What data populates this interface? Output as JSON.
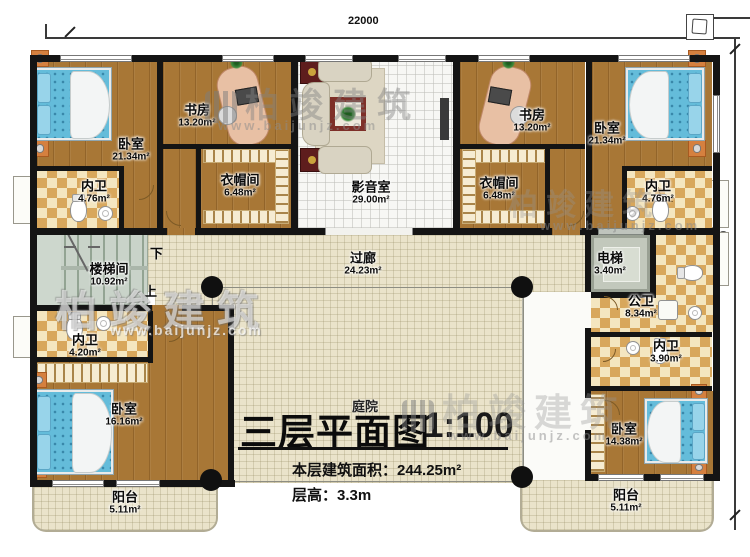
{
  "dimensions": {
    "width_top": "22000",
    "height_right": "15960"
  },
  "rooms": {
    "bedroom_top_left": {
      "name": "卧室",
      "area": "21.34m²"
    },
    "study_left": {
      "name": "书房",
      "area": "13.20m²"
    },
    "media_room": {
      "name": "影音室",
      "area": "29.00m²"
    },
    "study_right": {
      "name": "书房",
      "area": "13.20m²"
    },
    "bedroom_top_right": {
      "name": "卧室",
      "area": "21.34m²"
    },
    "bath_top_left": {
      "name": "内卫",
      "area": "4.76m²"
    },
    "cloakroom_left": {
      "name": "衣帽间",
      "area": "6.48m²"
    },
    "cloakroom_right": {
      "name": "衣帽间",
      "area": "6.48m²"
    },
    "bath_top_right": {
      "name": "内卫",
      "area": "4.76m²"
    },
    "stairwell": {
      "name": "楼梯间",
      "area": "10.92m²"
    },
    "corridor": {
      "name": "过廊",
      "area": "24.23m²"
    },
    "elevator": {
      "name": "电梯",
      "area": "3.40m²"
    },
    "public_bath": {
      "name": "公卫",
      "area": "8.34m²"
    },
    "bath_bottom_left": {
      "name": "内卫",
      "area": "4.20m²"
    },
    "bath_bottom_right": {
      "name": "内卫",
      "area": "3.90m²"
    },
    "bedroom_bottom_left": {
      "name": "卧室",
      "area": "16.16m²"
    },
    "bedroom_bottom_right": {
      "name": "卧室",
      "area": "14.38m²"
    },
    "balcony_left": {
      "name": "阳台",
      "area": "5.11m²"
    },
    "balcony_right": {
      "name": "阳台",
      "area": "5.11m²"
    }
  },
  "stairs": {
    "down_label": "下",
    "up_label": "上"
  },
  "courtyard_label": "庭院",
  "title": {
    "main": "三层平面图",
    "scale": "1:100",
    "area_line": "本层建筑面积：244.25m²",
    "height_line": "层高：3.3m"
  },
  "watermark": {
    "brand": "柏竣建筑",
    "url": "www.baijunjz.com"
  },
  "colors": {
    "wall": "#141414",
    "wood_floor": "#a87736",
    "tile_floor": "#eae3ca",
    "checker_dark": "#d8a75c",
    "checker_light": "#f4e6c0",
    "bed": "#64bcda",
    "stair": "#c9d3c9",
    "rug_red": "#7e2f28",
    "nightstand": "#d5803f"
  }
}
